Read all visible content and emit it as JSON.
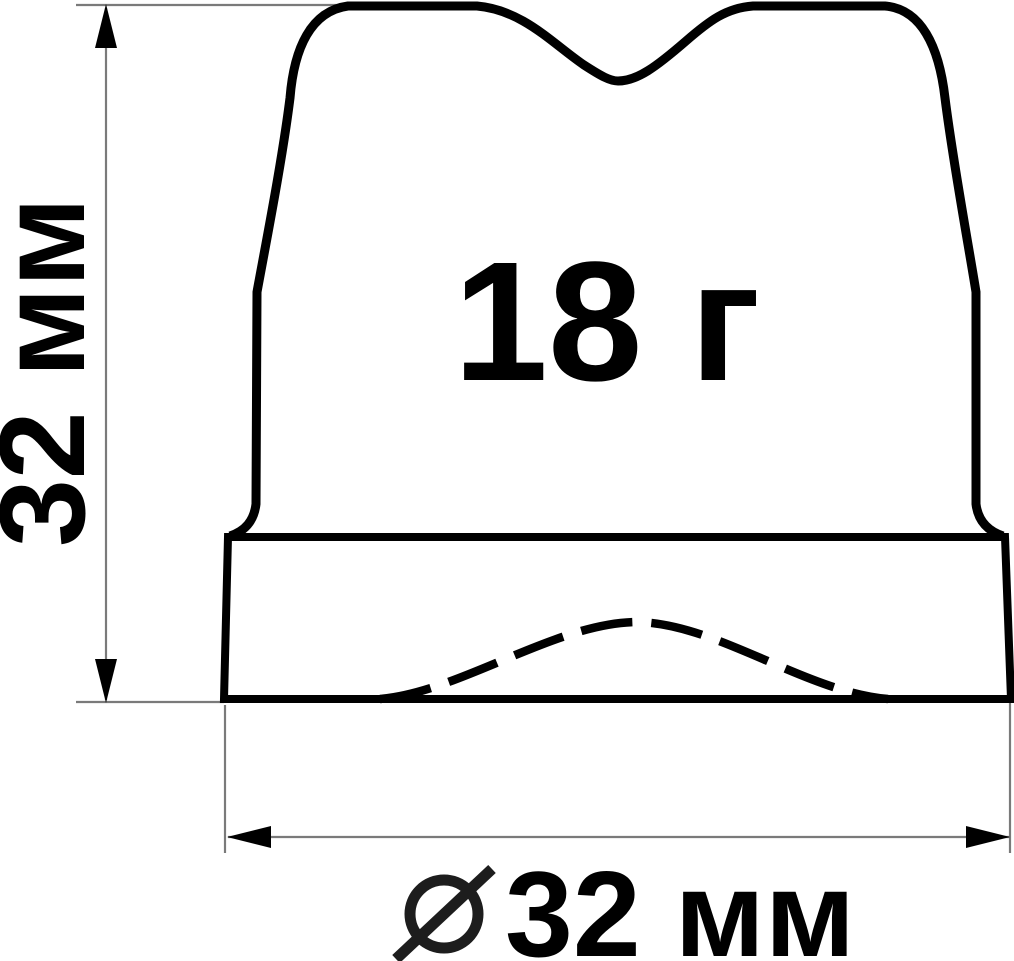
{
  "diagram": {
    "title_hint": "technical-drawing-of-molded-part-cross-section",
    "weight_label": "18 г",
    "height_dimension": "32 мм",
    "diameter_dimension": "32 мм",
    "diameter_symbol": "⌀",
    "colors": {
      "outline": "#000000",
      "dimension_lines": "#7a7a7a",
      "text": "#000000",
      "background": "#ffffff"
    }
  }
}
